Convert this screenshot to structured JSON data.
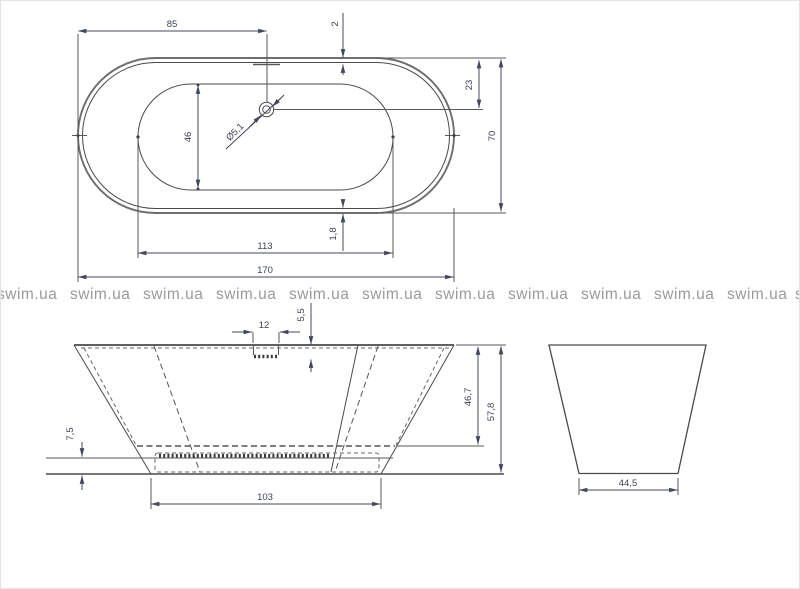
{
  "drawing_title": "bathtub-technical-drawing",
  "top_view": {
    "overall_length": "170",
    "overall_width": "70",
    "inner_length": "113",
    "inner_width": "46",
    "rim_thickness_top": "2",
    "rim_thickness_bottom": "1,8",
    "drain_from_left": "85",
    "drain_from_top": "23",
    "drain_diameter": "Ø5,1"
  },
  "front_view": {
    "overflow_width": "12",
    "overflow_depth": "5,5",
    "bottom_clearance": "7,5",
    "inner_depth": "46,7",
    "overall_height": "57,8",
    "base_length": "103"
  },
  "side_view": {
    "base_width": "44,5"
  },
  "watermark": {
    "text": "swim.ua",
    "color": "#9a9a9a"
  },
  "colors": {
    "line": "#4a4a4a",
    "dim_text": "#3d4254",
    "background": "#ffffff"
  }
}
